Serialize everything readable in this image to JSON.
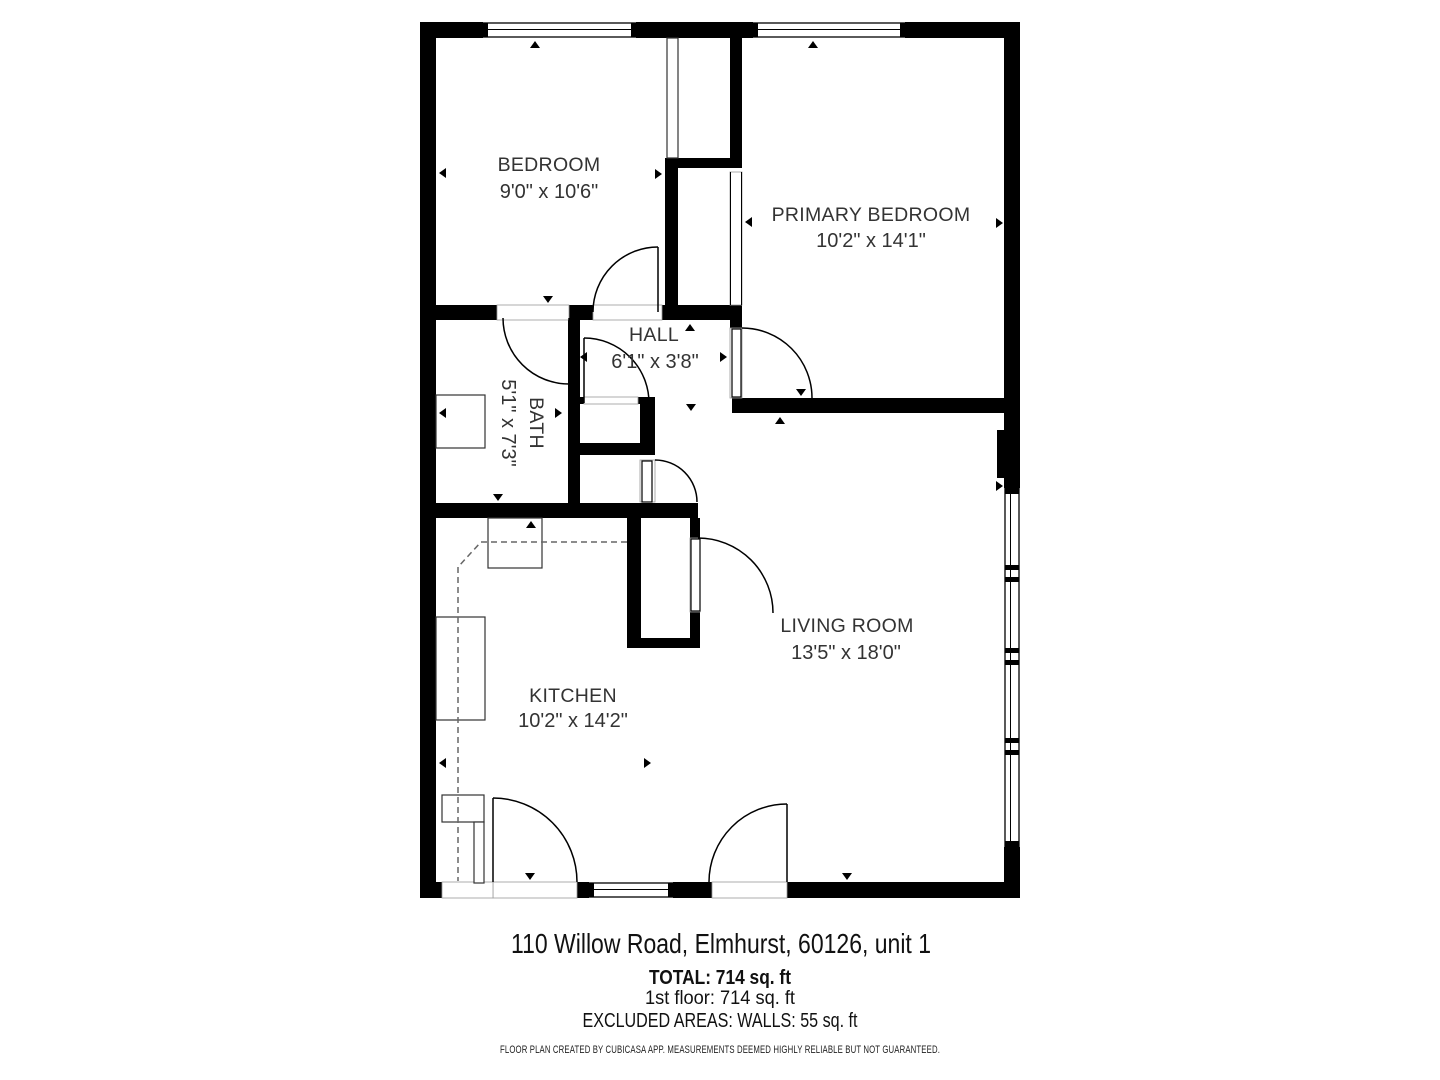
{
  "plan": {
    "rooms": [
      {
        "name": "BEDROOM",
        "dims": "9'0\" x 10'6\""
      },
      {
        "name": "PRIMARY BEDROOM",
        "dims": "10'2\" x 14'1\""
      },
      {
        "name": "HALL",
        "dims": "6'1\" x 3'8\""
      },
      {
        "name": "BATH",
        "dims": "5'1\" x 7'3\""
      },
      {
        "name": "LIVING ROOM",
        "dims": "13'5\" x 18'0\""
      },
      {
        "name": "KITCHEN",
        "dims": "10'2\" x 14'2\""
      }
    ]
  },
  "footer": {
    "address": "110 Willow Road, Elmhurst, 60126, unit 1",
    "total": "TOTAL: 714 sq. ft",
    "first_floor": "1st floor: 714 sq. ft",
    "excluded_areas": "EXCLUDED AREAS: WALLS: 55 sq. ft",
    "disclaimer": "FLOOR PLAN CREATED BY CUBICASA APP. MEASUREMENTS DEEMED HIGHLY RELIABLE BUT NOT GUARANTEED."
  },
  "colors": {
    "wall": "#000000",
    "background": "#ffffff",
    "label": "#333333"
  }
}
